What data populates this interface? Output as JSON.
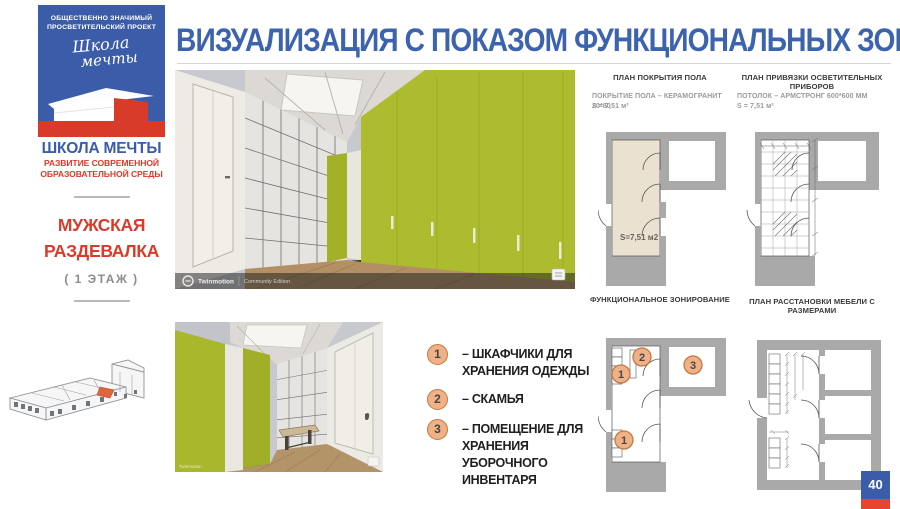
{
  "sidebar": {
    "logo": {
      "tagline": "ОБЩЕСТВЕННО ЗНАЧИМЫЙ ПРОСВЕТИТЕЛЬСКИЙ ПРОЕКТ",
      "script_line1": "Школа",
      "script_line2": "мечты"
    },
    "brand_title": "ШКОЛА МЕЧТЫ",
    "brand_subtitle": "РАЗВИТИЕ СОВРЕМЕННОЙ ОБРАЗОВАТЕЛЬНОЙ СРЕДЫ",
    "room_title": "МУЖСКАЯ РАЗДЕВАЛКА",
    "room_floor": "( 1 ЭТАЖ )"
  },
  "header": {
    "title": "ВИЗУАЛИЗАЦИЯ С ПОКАЗОМ ФУНКЦИОНАЛЬНЫХ ЗОН"
  },
  "renders": {
    "watermark_brand": "Twinmotion",
    "watermark_edition": "Community Edition"
  },
  "plans": {
    "floor_cover": {
      "title": "ПЛАН ПОКРЫТИЯ ПОЛА",
      "caption_line1": "ПОКРЫТИЕ ПОЛА – КЕРАМОГРАНИТ 20*80",
      "caption_line2": "S = 7,51 м²",
      "area_label": "S=7,51 м2"
    },
    "lighting": {
      "title": "ПЛАН ПРИВЯЗКИ ОСВЕТИТЕЛЬНЫХ ПРИБОРОВ",
      "caption_line1": "ПОТОЛОК – АРМСТРОНГ 600*600 ММ",
      "caption_line2": "S = 7,51 м²"
    },
    "zoning": {
      "title": "ФУНКЦИОНАЛЬНОЕ ЗОНИРОВАНИЕ",
      "markers": [
        {
          "label": "2"
        },
        {
          "label": "1"
        },
        {
          "label": "3"
        },
        {
          "label": "1"
        }
      ]
    },
    "furniture": {
      "title": "ПЛАН РАССТАНОВКИ МЕБЕЛИ С РАЗМЕРАМИ"
    }
  },
  "legend": {
    "items": [
      {
        "num": "1",
        "text": "– ШКАФЧИКИ ДЛЯ ХРАНЕНИЯ ОДЕЖДЫ"
      },
      {
        "num": "2",
        "text": "– СКАМЬЯ"
      },
      {
        "num": "3",
        "text": "– ПОМЕЩЕНИЕ ДЛЯ ХРАНЕНИЯ УБОРОЧНОГО ИНВЕНТАРЯ"
      }
    ]
  },
  "page": {
    "number": "40"
  },
  "colors": {
    "brand_blue": "#3b5ca9",
    "brand_red": "#d93b2b",
    "title_blue": "#3c63ae",
    "accent_green": "#adbc2e",
    "legend_circle_fill": "#efb185",
    "legend_circle_border": "#bf7a43",
    "plan_wall_gray": "#a9a9a9",
    "plan_floor_beige": "#eae1d1"
  }
}
